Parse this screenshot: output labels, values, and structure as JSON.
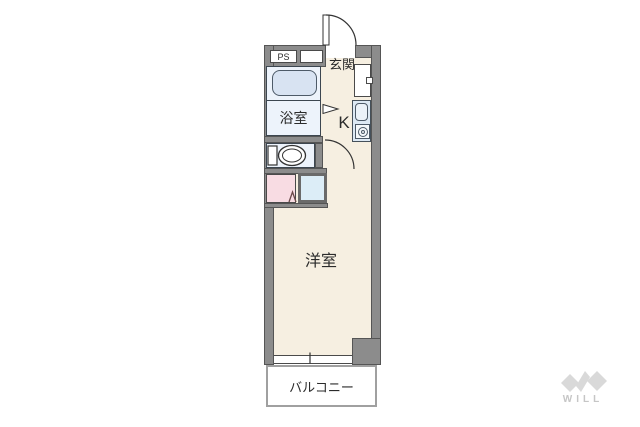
{
  "floor_plan": {
    "rooms": {
      "entrance_label": "玄関",
      "bathroom_label": "浴室",
      "kitchen_label": "K",
      "main_room_label": "洋室",
      "balcony_label": "バルコニー",
      "pipe_space_label": "PS"
    },
    "fixtures": [
      "bathtub",
      "toilet",
      "vanity-counter",
      "washing-machine-pan",
      "kitchen-sink",
      "stove-burner",
      "storage-cabinet",
      "entrance-door-swing",
      "toilet-door-swing",
      "sliding-window"
    ],
    "colors": {
      "wall": "#8c8c8c",
      "floor": "#f6efe1",
      "wet_area": "#edf3fb",
      "bathtub": "#d8e3f2",
      "vanity_pink": "#f8dce3",
      "washer_pan": "#dcedf7",
      "balcony_border": "#a0a0a0"
    }
  },
  "branding": {
    "logo_text": "WILL",
    "logo_color": "#d9d9d9"
  }
}
